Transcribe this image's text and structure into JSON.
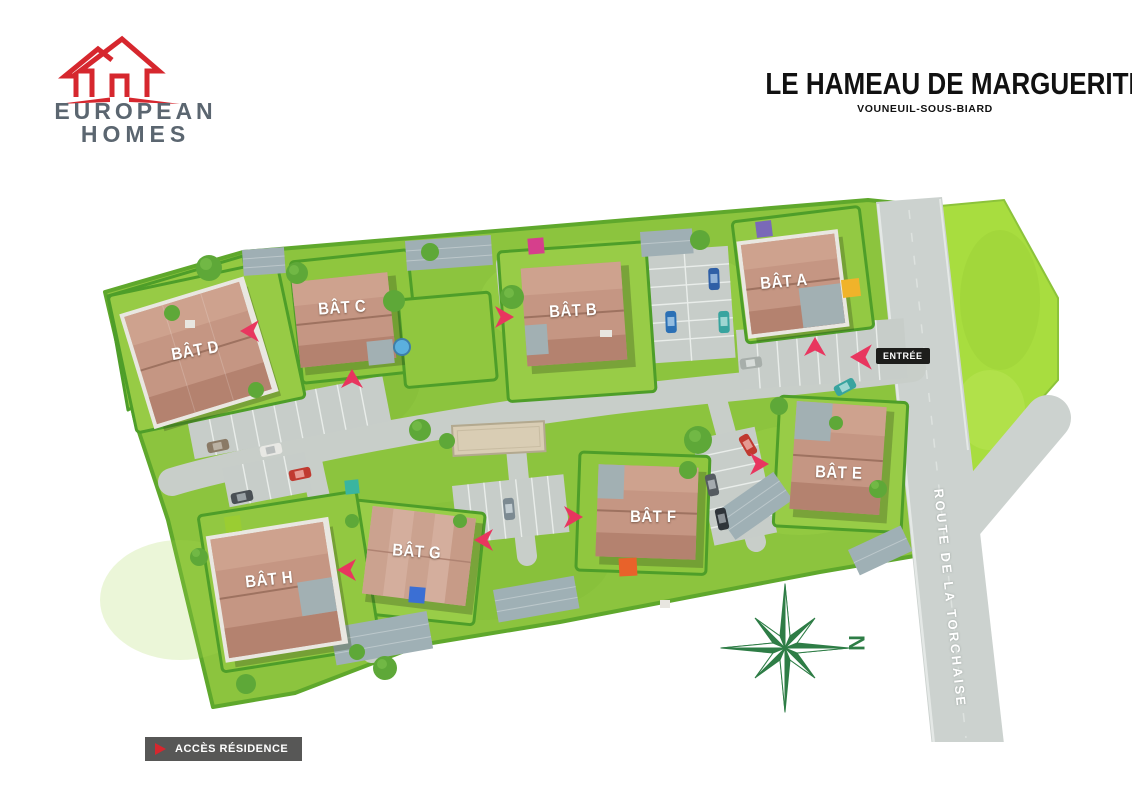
{
  "brand": {
    "logo_line1": "EUROPEAN",
    "logo_line2": "HOMES"
  },
  "header": {
    "title": "LE HAMEAU DE MARGUERITE",
    "subtitle": "VOUNEUIL-SOUS-BIARD"
  },
  "map": {
    "buildings": [
      {
        "id": "bat-a",
        "label": "BÂT A"
      },
      {
        "id": "bat-b",
        "label": "BÂT B"
      },
      {
        "id": "bat-c",
        "label": "BÂT C"
      },
      {
        "id": "bat-d",
        "label": "BÂT D"
      },
      {
        "id": "bat-e",
        "label": "BÂT E"
      },
      {
        "id": "bat-f",
        "label": "BÂT F"
      },
      {
        "id": "bat-g",
        "label": "BÂT G"
      },
      {
        "id": "bat-h",
        "label": "BÂT H"
      }
    ],
    "entrance_label": "ENTRÉE",
    "street_label": "ROUTE DE LA TORCHAISE",
    "compass_letter": "N"
  },
  "legend": {
    "access_label": "ACCÈS RÉSIDENCE"
  },
  "colors": {
    "logo_red": "#D6272E",
    "brand_gray": "#5B6670",
    "accent_pink": "#E8365F",
    "compass_green": "#2E7D46",
    "site_grass": "#8CC43E",
    "public_green": "#A8DD3F",
    "road_gray": "#CCD2CF",
    "roof_salmon": "#C59683",
    "legend_bg": "#575756"
  }
}
